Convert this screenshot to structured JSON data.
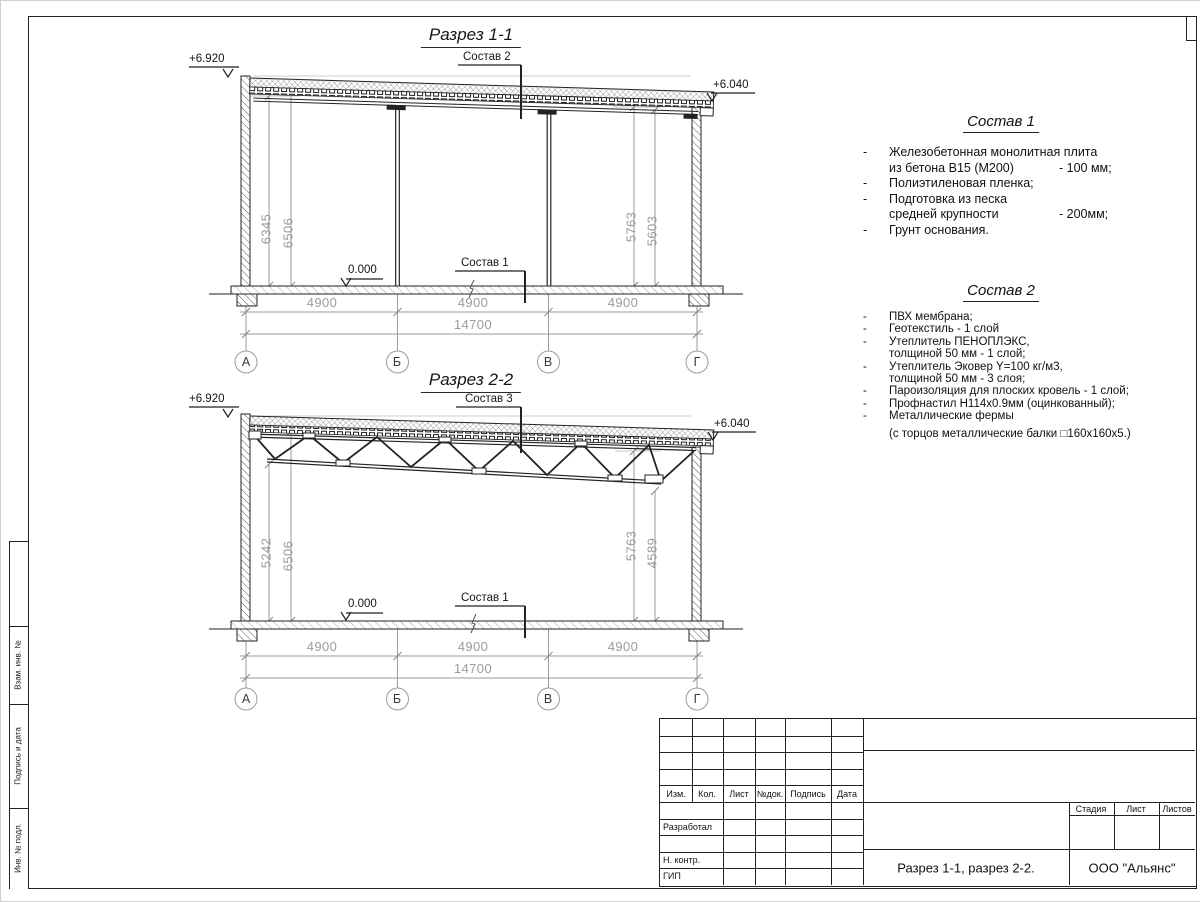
{
  "palette": {
    "line": "#1a1a1a",
    "dim": "#9b9b9b",
    "accent": "#ffffff"
  },
  "section1": {
    "title": "Разрез 1-1",
    "elev_left": "+6.920",
    "elev_right": "+6.040",
    "elev_zero": "0.000",
    "leader_top": "Состав 2",
    "leader_floor": "Состав 1",
    "dims_left": [
      "6345",
      "6506"
    ],
    "dims_right": [
      "5763",
      "5603"
    ],
    "dims_span": [
      "4900",
      "4900",
      "4900"
    ],
    "dim_total": "14700",
    "axes": [
      "А",
      "Б",
      "В",
      "Г"
    ]
  },
  "section2": {
    "title": "Разрез 2-2",
    "elev_left": "+6.920",
    "elev_right": "+6.040",
    "elev_zero": "0.000",
    "leader_top": "Состав 3",
    "leader_floor": "Состав 1",
    "dims_left": [
      "5242",
      "6506"
    ],
    "dims_right": [
      "5763",
      "4589"
    ],
    "dims_span": [
      "4900",
      "4900",
      "4900"
    ],
    "dim_total": "14700",
    "axes": [
      "А",
      "Б",
      "В",
      "Г"
    ]
  },
  "sostav1": {
    "title": "Состав 1",
    "items": [
      {
        "bullet": "-",
        "text": "Железобетонная  монолитная плита",
        "tail": ""
      },
      {
        "bullet": "",
        "text": "из бетона В15 (М200)",
        "tail": "- 100 мм;"
      },
      {
        "bullet": "-",
        "text": "Полиэтиленовая пленка;",
        "tail": ""
      },
      {
        "bullet": "-",
        "text": "Подготовка из песка",
        "tail": ""
      },
      {
        "bullet": "",
        "text": "средней крупности",
        "tail": "- 200мм;"
      },
      {
        "bullet": "-",
        "text": "Грунт основания.",
        "tail": ""
      }
    ]
  },
  "sostav2": {
    "title": "Состав 2",
    "items": [
      {
        "bullet": "-",
        "text": "ПВХ мембрана;"
      },
      {
        "bullet": "-",
        "text": "Геотекстиль - 1 слой"
      },
      {
        "bullet": "-",
        "text": "Утеплитель ПЕНОПЛЭКС,"
      },
      {
        "bullet": "",
        "text": "толщиной 50 мм - 1 слой;"
      },
      {
        "bullet": "-",
        "text": "Утеплитель Эковер Y=100 кг/м3,"
      },
      {
        "bullet": "",
        "text": "толщиной 50 мм - 3 слоя;"
      },
      {
        "bullet": "-",
        "text": "Пароизоляция для плоских кровель - 1 слой;"
      },
      {
        "bullet": "-",
        "text": "Профнастил Н114х0.9мм (оцинкованный);"
      },
      {
        "bullet": "-",
        "text": "Металлические фермы"
      },
      {
        "bullet": "",
        "text": "(с торцов металлические балки □160х160х5.)"
      }
    ]
  },
  "titleblock": {
    "header_cols": [
      "Изм.",
      "Кол.",
      "Лист",
      "№док.",
      "Подпись",
      "Дата"
    ],
    "row_razrab": "Разработал",
    "row_nkontr": "Н. контр.",
    "row_gip": "ГИП",
    "stage_cols": [
      "Стадия",
      "Лист",
      "Листов"
    ],
    "doc_title": "Разрез 1-1, разрез 2-2.",
    "company": "ООО \"Альянс\""
  },
  "margin": {
    "labels": [
      "Взам. инв. №",
      "Подпись и дата",
      "Инв. № подл."
    ]
  }
}
